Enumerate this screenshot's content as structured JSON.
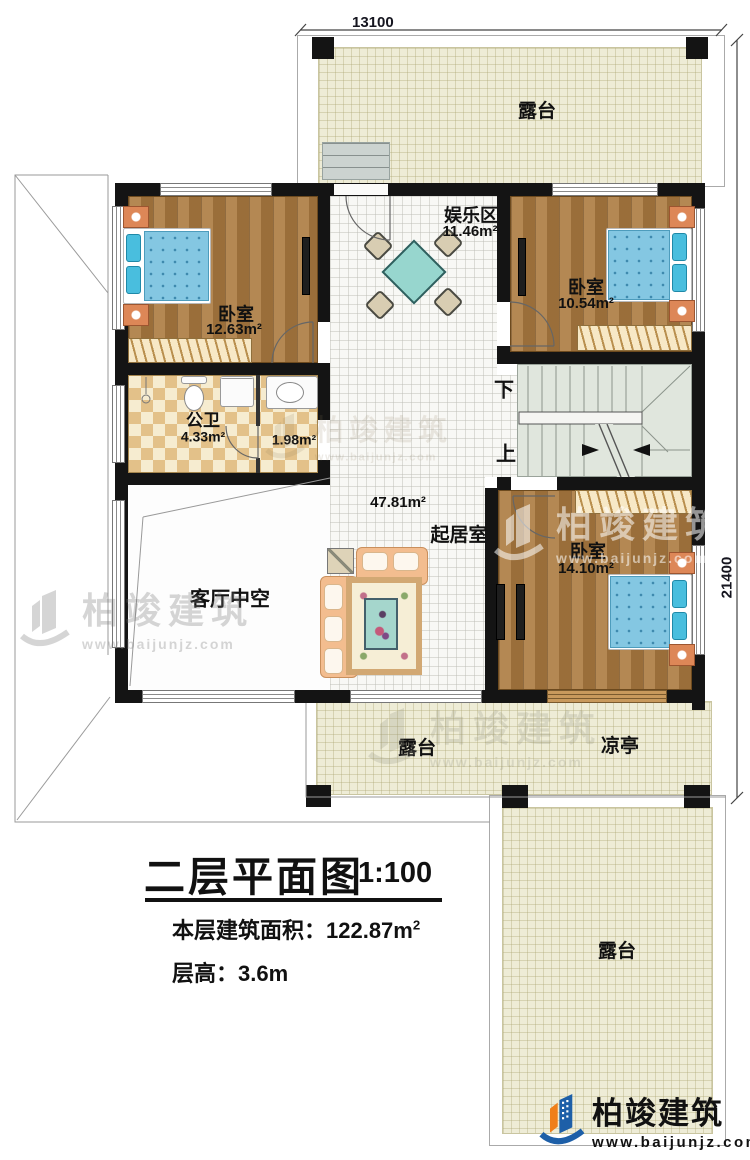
{
  "floor_plan": {
    "dimensions": {
      "top": "13100",
      "right": "21400"
    },
    "stairs": {
      "down": "下",
      "up": "上"
    },
    "rooms": {
      "terrace_top": "露台",
      "terrace_strip": "露台",
      "pavilion": "凉亭",
      "terrace_bottom_right": "露台",
      "entertainment": {
        "name": "娱乐区",
        "area": "11.46m²"
      },
      "bedroom_left": {
        "name": "卧室",
        "area": "12.63m²"
      },
      "bedroom_right": {
        "name": "卧室",
        "area": "10.54m²"
      },
      "bedroom_bottom": {
        "name": "卧室",
        "area": "14.10m²"
      },
      "bathroom": {
        "name": "公卫",
        "area": "4.33m²",
        "annex_area": "1.98m²"
      },
      "living": {
        "name": "起居室",
        "area": "47.81m²"
      },
      "void": "客厅中空"
    },
    "title_block": {
      "title": "二层平面图",
      "scale": "1:100",
      "floor_area": "本层建筑面积：122.87m",
      "floor_area_sup": "2",
      "floor_height": "层高：3.6m"
    },
    "branding": {
      "name": "柏竣建筑",
      "url": "www.baijunjz.com",
      "brand_blue": "#1d5fa8",
      "brand_orange": "#f07f1a"
    }
  }
}
